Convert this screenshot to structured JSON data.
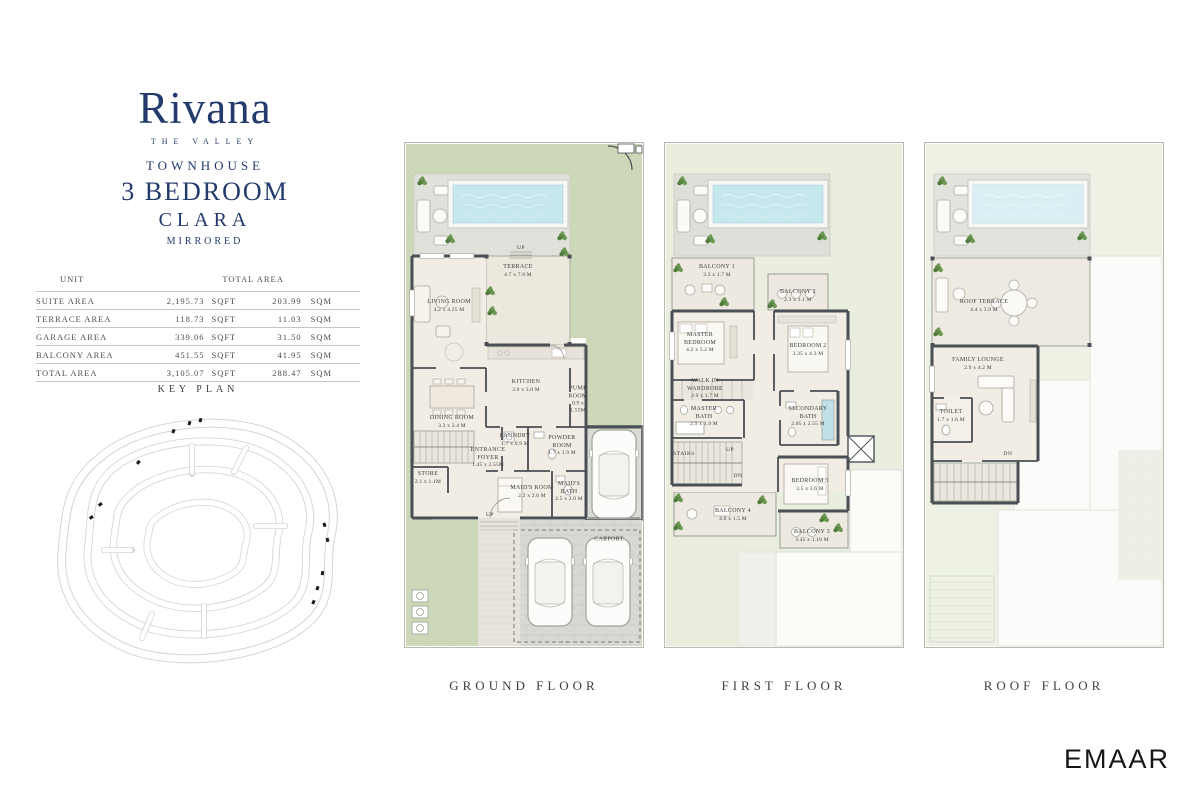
{
  "brand": {
    "name": "Rivana",
    "tagline": "THE VALLEY"
  },
  "unit": {
    "type": "TOWNHOUSE",
    "bedrooms": "3 BEDROOM",
    "model": "CLARA",
    "variant": "MIRRORED"
  },
  "area_table": {
    "headers": {
      "unit": "UNIT",
      "total": "TOTAL AREA"
    },
    "rows": [
      {
        "label": "SUITE AREA",
        "sqft": "2,195.73",
        "sqft_unit": "SQFT",
        "sqm": "203.99",
        "sqm_unit": "SQM"
      },
      {
        "label": "TERRACE AREA",
        "sqft": "118.73",
        "sqft_unit": "SQFT",
        "sqm": "11.03",
        "sqm_unit": "SQM"
      },
      {
        "label": "GARAGE AREA",
        "sqft": "339.06",
        "sqft_unit": "SQFT",
        "sqm": "31.50",
        "sqm_unit": "SQM"
      },
      {
        "label": "BALCONY AREA",
        "sqft": "451.55",
        "sqft_unit": "SQFT",
        "sqm": "41.95",
        "sqm_unit": "SQM"
      },
      {
        "label": "TOTAL AREA",
        "sqft": "3,105.07",
        "sqft_unit": "SQFT",
        "sqm": "288.47",
        "sqm_unit": "SQM"
      }
    ]
  },
  "key_plan": {
    "title": "KEY PLAN"
  },
  "floors": [
    {
      "caption": "GROUND FLOOR",
      "rooms": [
        {
          "name": "TERRACE",
          "dim": "4.7 x 7.8 M"
        },
        {
          "name": "LIVING ROOM",
          "dim": "4.2 x 4.25 M"
        },
        {
          "name": "DINING ROOM",
          "dim": "3.3 x 2.4 M"
        },
        {
          "name": "KITCHEN",
          "dim": "3.0 x 3.0 M"
        },
        {
          "name": "PUMP ROOM",
          "dim": "0.9 x 1.55M"
        },
        {
          "name": "LAUNDRY",
          "dim": "1.7 x 0.9 M"
        },
        {
          "name": "POWDER ROOM",
          "dim": "1.7 x 1.9 M"
        },
        {
          "name": "ENTRANCE FOYER",
          "dim": "1.45 x 2.55M"
        },
        {
          "name": "STORE",
          "dim": "2.1 x 1.1M"
        },
        {
          "name": "MAID'S ROOM",
          "dim": "2.2 x 2.6 M"
        },
        {
          "name": "MAID'S BATH",
          "dim": "2.5 x 2.0 M"
        },
        {
          "name": "CARPORT",
          "dim": ""
        }
      ],
      "labels": {
        "up_terrace": "UP",
        "up_path": "UP"
      }
    },
    {
      "caption": "FIRST FLOOR",
      "rooms": [
        {
          "name": "BALCONY 1",
          "dim": "3.3 x 1.7 M"
        },
        {
          "name": "BALCONY 2",
          "dim": "2.3 x 1.1 M"
        },
        {
          "name": "MASTER BEDROOM",
          "dim": "4.2 x 5.2 M"
        },
        {
          "name": "BEDROOM 2",
          "dim": "3.35 x 4.3 M"
        },
        {
          "name": "WALK IN WARDROBE",
          "dim": "2.9 x 1.7 M"
        },
        {
          "name": "MASTER BATH",
          "dim": "2.9 x 1.9 M"
        },
        {
          "name": "SECONDARY BATH",
          "dim": "2.05 x 2.55 M"
        },
        {
          "name": "BEDROOM 3",
          "dim": "3.5 x 3.6 M"
        },
        {
          "name": "BALCONY 4",
          "dim": "4.0 x 1.5 M"
        },
        {
          "name": "BALCONY 3",
          "dim": "3.45 x 1.18 M"
        }
      ],
      "labels": {
        "stairs": "STAIRS",
        "up": "UP",
        "dn": "DN"
      }
    },
    {
      "caption": "ROOF FLOOR",
      "rooms": [
        {
          "name": "ROOF TERRACE",
          "dim": "4.4 x 3.9 M"
        },
        {
          "name": "FAMILY LOUNGE",
          "dim": "2.9 x 4.2 M"
        },
        {
          "name": "TOILET",
          "dim": "1.7 x 1.6 M"
        }
      ],
      "labels": {
        "dn": "DN"
      }
    }
  ],
  "footer": {
    "logo": "EMAAR"
  },
  "colors": {
    "navy": "#233a6c",
    "garden_green": "#ccd8b8",
    "pale_green": "#e9eedf",
    "roof_green": "#eef2e5",
    "pool_blue": "#c5e7ed",
    "wall": "#4a4f55"
  }
}
